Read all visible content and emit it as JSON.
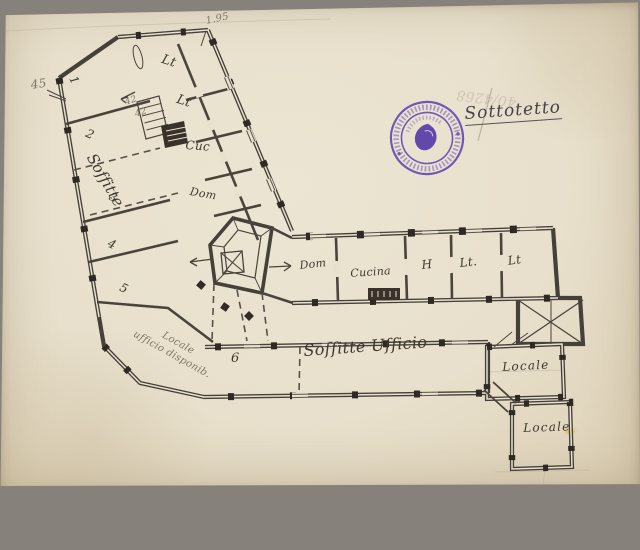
{
  "annotations": {
    "title": "Sottotetto",
    "pencil_number": "40/4268",
    "measure_top": "1.95",
    "measure_left": "45",
    "stair_note_a": "42",
    "stair_note_b": "42",
    "note_line1": "Locale",
    "note_line2": "ufficio disponib."
  },
  "rooms": {
    "left_wing": {
      "r1": "1",
      "r2": "2",
      "soffitte": "Soffitte",
      "r3": "3",
      "r4": "4",
      "r5": "5"
    },
    "north_wing": {
      "lt1": "Lt",
      "lt2": "Lt",
      "cuc": "Cuc",
      "dom": "Dom"
    },
    "east_wing": {
      "dom": "Dom",
      "cucina": "Cucina",
      "h": "H",
      "lt1": "Lt.",
      "lt2": "Lt"
    },
    "south_wing": {
      "r6": "6",
      "soffitte_ufficio": "Soffitte Ufficio"
    },
    "south_east": {
      "locale1": "Locale",
      "locale2": "Locale"
    }
  },
  "colors": {
    "ink": "#3e382f",
    "pencil": "#7e7668",
    "stamp_purple": "#5b3fb2",
    "paper": "#e9e1cd"
  }
}
